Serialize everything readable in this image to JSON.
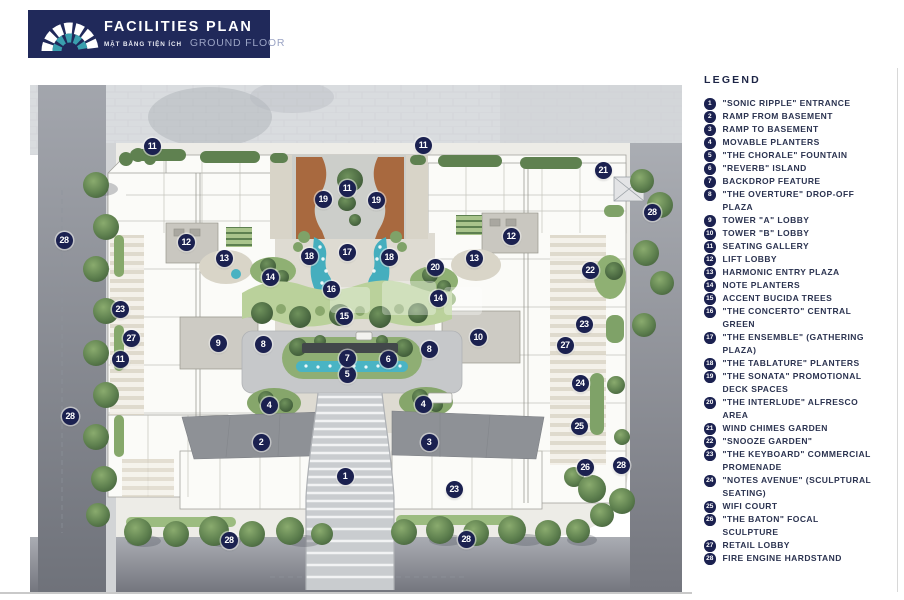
{
  "header": {
    "title": "FACILITIES PLAN",
    "subtitle_vi": "MẶT BẰNG TIỆN ÍCH",
    "subtitle_en": "GROUND FLOOR"
  },
  "legend": {
    "title": "LEGEND",
    "items": [
      {
        "num": 1,
        "label": "\"SONIC RIPPLE\" ENTRANCE"
      },
      {
        "num": 2,
        "label": "RAMP FROM BASEMENT"
      },
      {
        "num": 3,
        "label": "RAMP TO BASEMENT"
      },
      {
        "num": 4,
        "label": "MOVABLE PLANTERS"
      },
      {
        "num": 5,
        "label": "\"THE CHORALE\" FOUNTAIN"
      },
      {
        "num": 6,
        "label": "\"REVERB\" ISLAND"
      },
      {
        "num": 7,
        "label": "BACKDROP FEATURE"
      },
      {
        "num": 8,
        "label": "\"THE OVERTURE\" DROP-OFF PLAZA"
      },
      {
        "num": 9,
        "label": "TOWER \"A\" LOBBY"
      },
      {
        "num": 10,
        "label": "TOWER \"B\" LOBBY"
      },
      {
        "num": 11,
        "label": "SEATING GALLERY"
      },
      {
        "num": 12,
        "label": "LIFT LOBBY"
      },
      {
        "num": 13,
        "label": "HARMONIC ENTRY PLAZA"
      },
      {
        "num": 14,
        "label": "NOTE PLANTERS"
      },
      {
        "num": 15,
        "label": "ACCENT BUCIDA TREES"
      },
      {
        "num": 16,
        "label": "\"THE CONCERTO\" CENTRAL GREEN"
      },
      {
        "num": 17,
        "label": "\"THE ENSEMBLE\" (GATHERING PLAZA)"
      },
      {
        "num": 18,
        "label": "\"THE TABLATURE\" PLANTERS"
      },
      {
        "num": 19,
        "label": "\"THE SONATA\" PROMOTIONAL DECK SPACES"
      },
      {
        "num": 20,
        "label": "\"THE INTERLUDE\" ALFRESCO AREA"
      },
      {
        "num": 21,
        "label": "WIND CHIMES GARDEN"
      },
      {
        "num": 22,
        "label": "\"SNOOZE GARDEN\""
      },
      {
        "num": 23,
        "label": "\"THE KEYBOARD\" COMMERCIAL PROMENADE"
      },
      {
        "num": 24,
        "label": "\"NOTES AVENUE\" (SCULPTURAL SEATING)"
      },
      {
        "num": 25,
        "label": "WIFI COURT"
      },
      {
        "num": 26,
        "label": "\"THE BATON\" FOCAL SCULPTURE"
      },
      {
        "num": 27,
        "label": "RETAIL LOBBY"
      },
      {
        "num": 28,
        "label": "FIRE ENGINE HARDSTAND"
      }
    ]
  },
  "plan": {
    "markers": [
      {
        "n": "1",
        "x": 315,
        "y": 391
      },
      {
        "n": "2",
        "x": 231,
        "y": 357
      },
      {
        "n": "3",
        "x": 399,
        "y": 357
      },
      {
        "n": "4",
        "x": 239,
        "y": 320
      },
      {
        "n": "4",
        "x": 393,
        "y": 319
      },
      {
        "n": "5",
        "x": 317,
        "y": 289
      },
      {
        "n": "6",
        "x": 358,
        "y": 274
      },
      {
        "n": "7",
        "x": 317,
        "y": 273
      },
      {
        "n": "8",
        "x": 233,
        "y": 259
      },
      {
        "n": "8",
        "x": 399,
        "y": 264
      },
      {
        "n": "9",
        "x": 188,
        "y": 258
      },
      {
        "n": "10",
        "x": 448,
        "y": 252
      },
      {
        "n": "11",
        "x": 122,
        "y": 61
      },
      {
        "n": "11",
        "x": 393,
        "y": 60
      },
      {
        "n": "11",
        "x": 317,
        "y": 103
      },
      {
        "n": "11",
        "x": 90,
        "y": 274
      },
      {
        "n": "12",
        "x": 156,
        "y": 157
      },
      {
        "n": "12",
        "x": 481,
        "y": 151
      },
      {
        "n": "13",
        "x": 194,
        "y": 173
      },
      {
        "n": "13",
        "x": 444,
        "y": 173
      },
      {
        "n": "14",
        "x": 240,
        "y": 192
      },
      {
        "n": "14",
        "x": 408,
        "y": 213
      },
      {
        "n": "15",
        "x": 314,
        "y": 231
      },
      {
        "n": "16",
        "x": 301,
        "y": 204
      },
      {
        "n": "17",
        "x": 317,
        "y": 167
      },
      {
        "n": "18",
        "x": 279,
        "y": 171
      },
      {
        "n": "18",
        "x": 359,
        "y": 172
      },
      {
        "n": "19",
        "x": 293,
        "y": 114
      },
      {
        "n": "19",
        "x": 346,
        "y": 115
      },
      {
        "n": "20",
        "x": 405,
        "y": 182
      },
      {
        "n": "21",
        "x": 573,
        "y": 85
      },
      {
        "n": "22",
        "x": 560,
        "y": 185
      },
      {
        "n": "23",
        "x": 90,
        "y": 224
      },
      {
        "n": "23",
        "x": 554,
        "y": 239
      },
      {
        "n": "23",
        "x": 424,
        "y": 404
      },
      {
        "n": "24",
        "x": 550,
        "y": 298
      },
      {
        "n": "25",
        "x": 549,
        "y": 341
      },
      {
        "n": "26",
        "x": 555,
        "y": 382
      },
      {
        "n": "27",
        "x": 101,
        "y": 253
      },
      {
        "n": "27",
        "x": 535,
        "y": 260
      },
      {
        "n": "28",
        "x": 34,
        "y": 155
      },
      {
        "n": "28",
        "x": 40,
        "y": 331
      },
      {
        "n": "28",
        "x": 622,
        "y": 127
      },
      {
        "n": "28",
        "x": 591,
        "y": 380
      },
      {
        "n": "28",
        "x": 199,
        "y": 455
      },
      {
        "n": "28",
        "x": 436,
        "y": 454
      }
    ]
  },
  "colors": {
    "header_navy": "#20295a",
    "logo_teal": "#3a9fae",
    "marker_navy": "#1b2150",
    "legend_text": "#2b3350",
    "deck_brown": "#a8693f",
    "water_teal": "#4ab4c4",
    "green_dark": "#55754a",
    "green_light": "#b9d099",
    "road_gray": "#8d9097",
    "top_paving": "#d9dcdf"
  }
}
